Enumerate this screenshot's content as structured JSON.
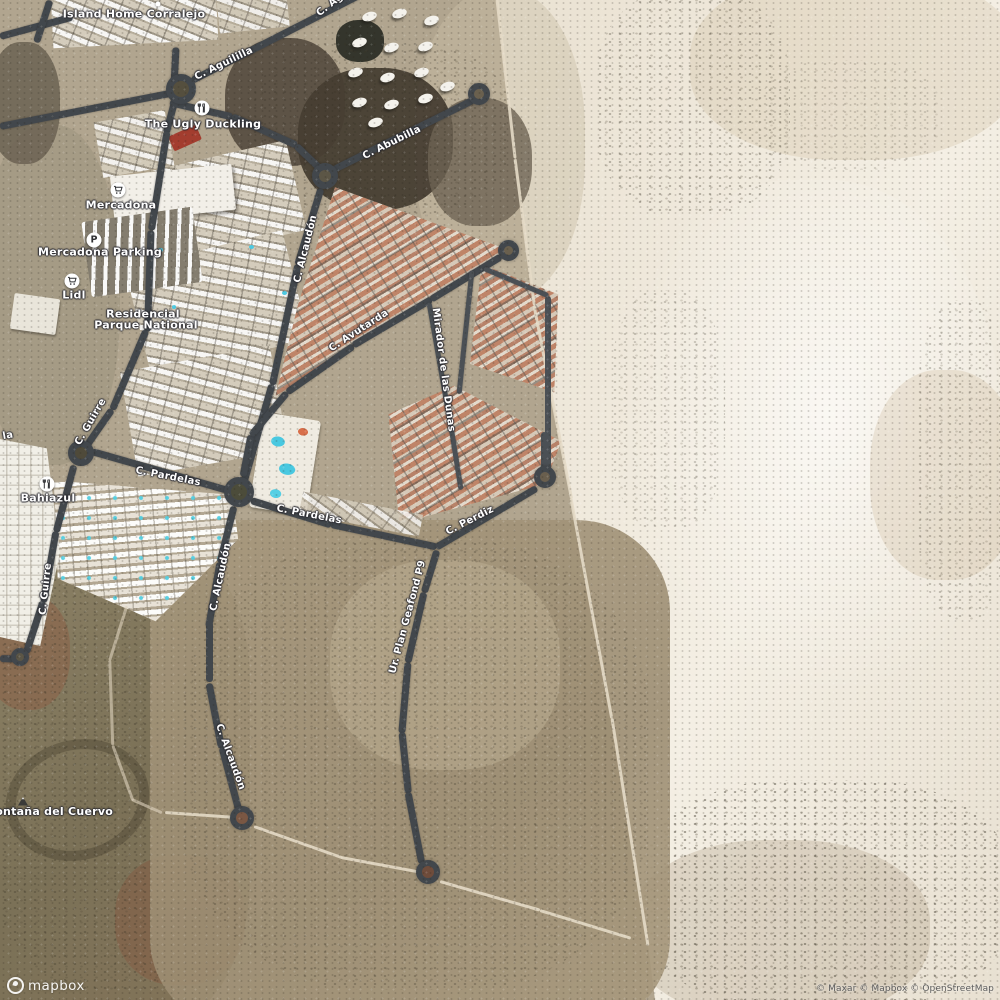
{
  "streets": {
    "aguililla": "C. Aguililla",
    "aguililla_top": "C. Agu",
    "abubilla": "C. Abubilla",
    "alcaudon_n": "C. Alcaudón",
    "alcaudon_mid": "C. Alcaudón",
    "alcaudon_s": "C. Alcaudón",
    "avutarda": "C. Avutarda",
    "mirador": "Mirador de las Dunas",
    "guirre_n": "C. Guirre",
    "guirre_s": "C. Guirre",
    "pardelas_w": "C. Pardelas",
    "pardelas_e": "C. Pardelas",
    "perdiz": "C. Perdiz",
    "geafond": "Ur. Plan Geafond P9",
    "fragment_la": "la"
  },
  "pois": {
    "island_home": "Island Home Corralejo",
    "ugly_duckling": "The Ugly Duckling",
    "mercadona": "Mercadona",
    "mercadona_parking": "Mercadona Parking",
    "lidl": "Lidl",
    "bahiazul": "Bahiazul",
    "residencial_line1": "Residencial",
    "residencial_line2": "Parque National",
    "montana": "Montaña del Cuervo"
  },
  "branding": {
    "logo_text": "mapbox",
    "attribution": "© Maxar © Mapbox © OpenStreetMap"
  },
  "colors": {
    "road": "#42474c",
    "dunes": "#ece6d8",
    "terrain": "#b1a58f",
    "pool": "#4cc9e2",
    "label": "#ffffff"
  }
}
